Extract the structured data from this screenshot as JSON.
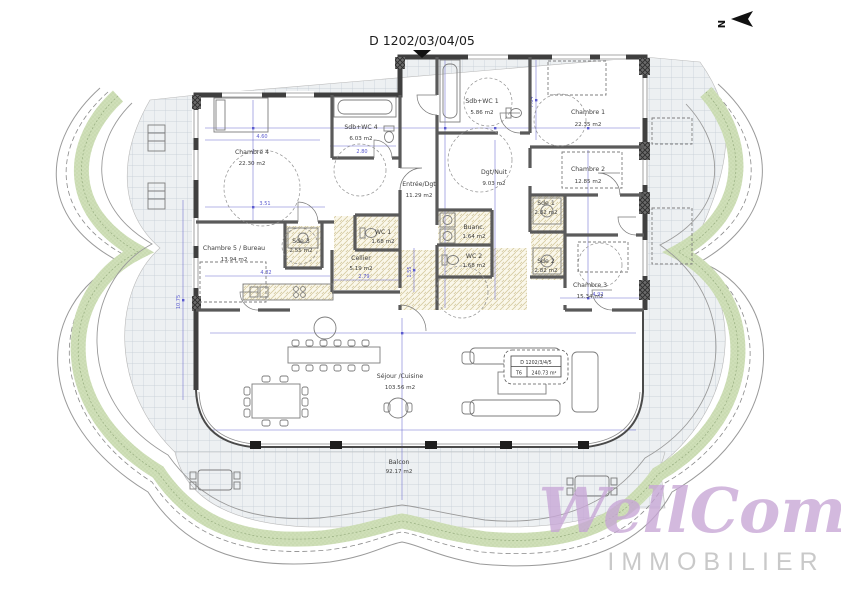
{
  "title": "D 1202/03/04/05",
  "north": {
    "label": "N"
  },
  "rooms": [
    {
      "name": "Chambre 4",
      "area": "22.30 m2"
    },
    {
      "name": "Sdb+WC 4",
      "area": "6.03 m2"
    },
    {
      "name": "Entrée/Dgt",
      "area": "11.29 m2"
    },
    {
      "name": "Sdb+WC 1",
      "area": "5.86 m2"
    },
    {
      "name": "Chambre 1",
      "area": "22.35 m2"
    },
    {
      "name": "Dgt/Nuit",
      "area": "9.03 m2"
    },
    {
      "name": "Chambre 2",
      "area": "12.85 m2"
    },
    {
      "name": "Chambre 5 / Bureau",
      "area": "13.94 m2"
    },
    {
      "name": "Sde 3",
      "area": "2.55 m2"
    },
    {
      "name": "WC 1",
      "area": "1.68 m2"
    },
    {
      "name": "Cellier",
      "area": "5.19 m2"
    },
    {
      "name": "Buanc.",
      "area": "1.64 m2"
    },
    {
      "name": "WC 2",
      "area": "1.68 m2"
    },
    {
      "name": "Sde 1",
      "area": "2.82 m2"
    },
    {
      "name": "Sde 2",
      "area": "2.82 m2"
    },
    {
      "name": "Chambre 3",
      "area": "15.34 m2"
    },
    {
      "name": "Séjour /Cuisine",
      "area": "103.56 m2"
    },
    {
      "name": "Balcon",
      "area": "92.17 m2"
    }
  ],
  "info_box": {
    "lot": "D 1202/3/4/5",
    "type": "T6",
    "total_area": "240.73 m²"
  },
  "dimensions": [
    "4.60",
    "3.51",
    "2.80",
    "7.04",
    "4.82",
    "2.79",
    "10.75",
    "1.55",
    "4.92"
  ],
  "watermark": {
    "line1": "WellCome",
    "line2": "IMMOBILIER"
  },
  "colors": {
    "green_band": "#cfdfb8",
    "wall": "#3f3f3f",
    "dimension_blue": "#5b5bd0",
    "hatch": "#d6cba2",
    "watermark_script": "#c7a6d6",
    "watermark_caps": "#c7c7c7"
  }
}
